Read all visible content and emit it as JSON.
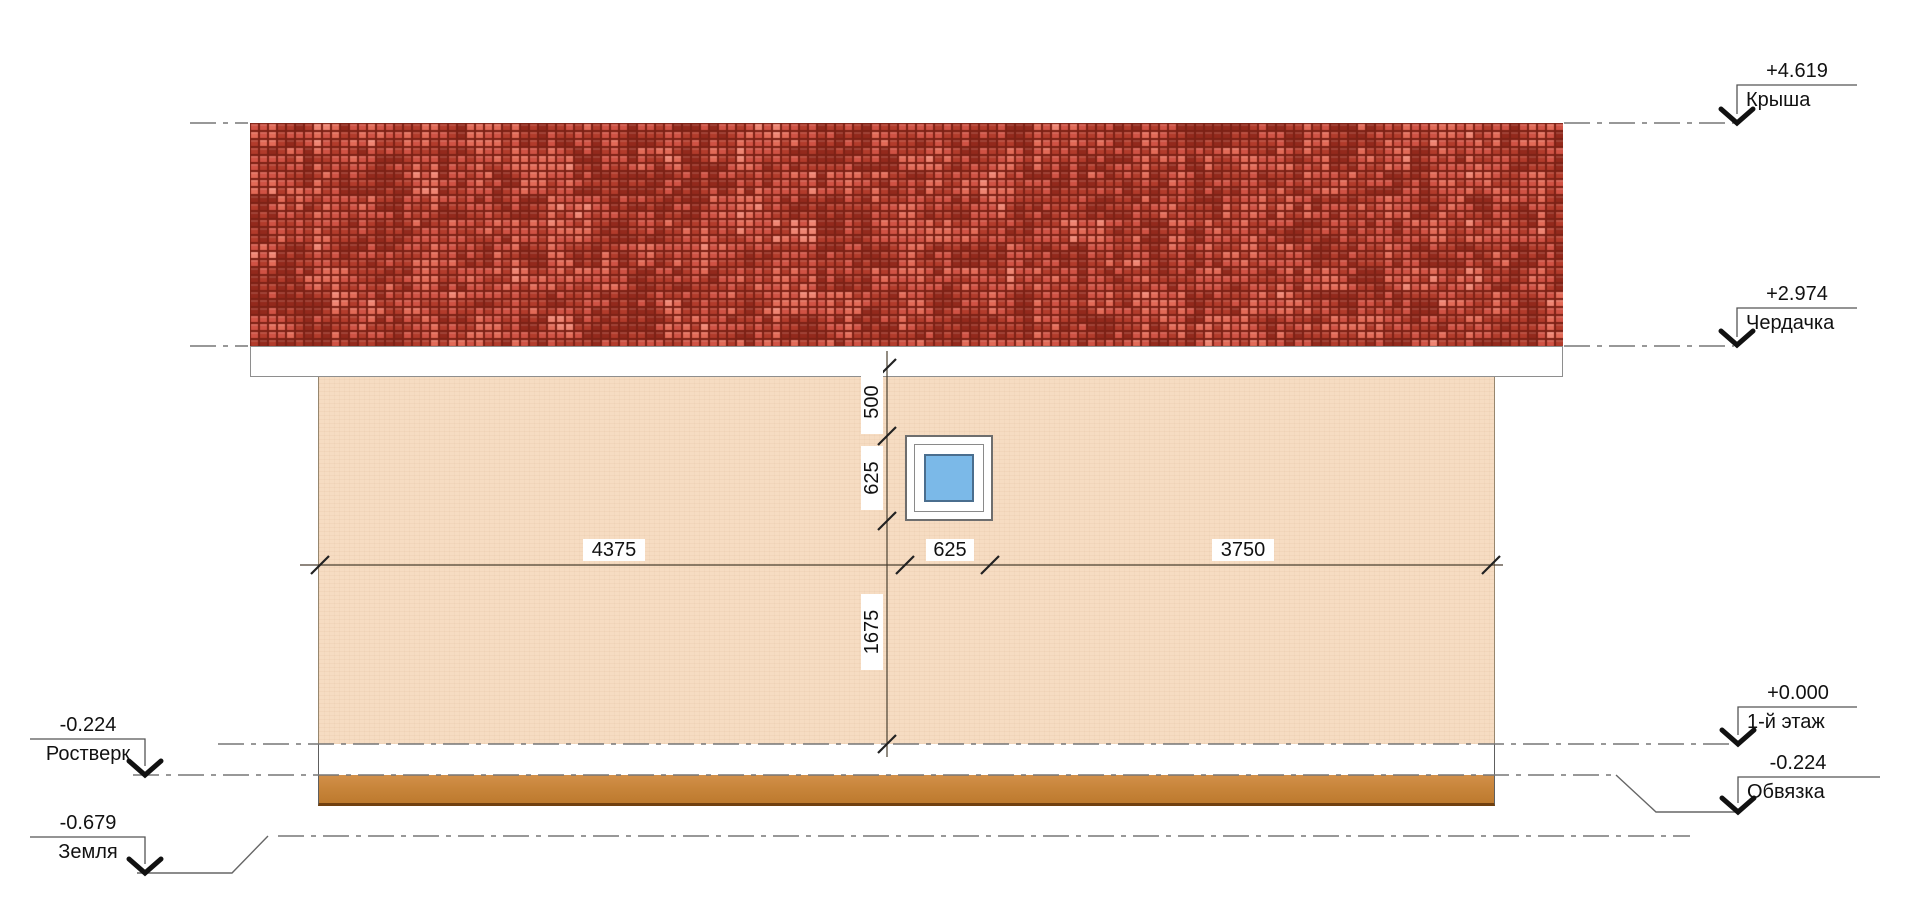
{
  "drawing": {
    "type": "house-side-elevation",
    "language": "ru"
  },
  "levels": {
    "right": [
      {
        "value": "+4.619",
        "label": "Крыша"
      },
      {
        "value": "+2.974",
        "label": "Чердачка"
      },
      {
        "value": "+0.000",
        "label": "1-й этаж"
      },
      {
        "value": "-0.224",
        "label": "Обвязка"
      }
    ],
    "left": [
      {
        "value": "-0.224",
        "label": "Ростверк"
      },
      {
        "value": "-0.679",
        "label": "Земля"
      }
    ]
  },
  "dimensions": {
    "horizontal": [
      "4375",
      "625",
      "3750"
    ],
    "vertical": [
      "500",
      "625",
      "1675"
    ]
  },
  "colors": {
    "wall": "#f6dcc2",
    "fascia": "#ffffff",
    "strapping": "#c8853b",
    "strapping_border": "#70400f",
    "window_glass": "#7bb9e8",
    "window_frame": "#ffffff",
    "dimension_line": "#4a3f30",
    "level_line": "#777777",
    "marker_arrow": "#111111"
  },
  "roof": {
    "palette": [
      "#ef8472",
      "#e26a57",
      "#d05244",
      "#b23b2b",
      "#93291c"
    ],
    "grout": "#7c2115",
    "tile_w": 9,
    "tile_h": 8
  }
}
